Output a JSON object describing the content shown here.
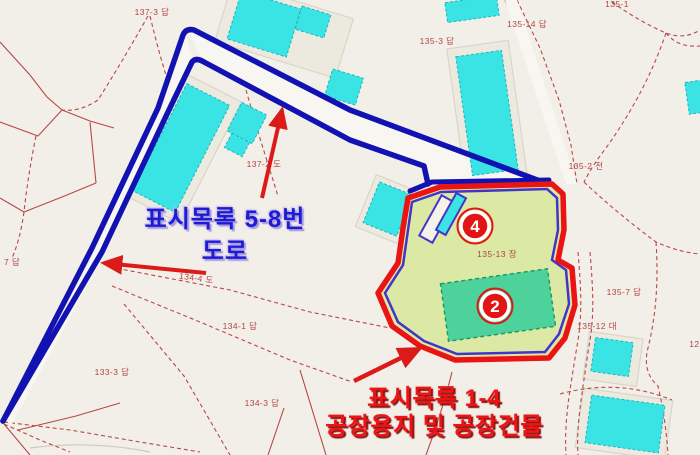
{
  "labels": {
    "road": {
      "line1": "표시목록 5-8번",
      "line2": "도로"
    },
    "factory": {
      "line1": "표시목록 1-4",
      "line2": "공장용지 및 공장건물"
    }
  },
  "markers": [
    {
      "label": "4"
    },
    {
      "label": "2"
    }
  ],
  "parcel_labels": [
    {
      "text": "137-3 답"
    },
    {
      "text": "135-3 답"
    },
    {
      "text": "135-14 답"
    },
    {
      "text": "135-1"
    },
    {
      "text": "135-2 전"
    },
    {
      "text": "135-7 답"
    },
    {
      "text": "135-12 대"
    },
    {
      "text": "123"
    },
    {
      "text": "134-1 답"
    },
    {
      "text": "133-3 답"
    },
    {
      "text": "134-3 답"
    },
    {
      "text": "7 답"
    },
    {
      "text": "137-2 도"
    },
    {
      "text": "135-13 장"
    },
    {
      "text": "134-4 도"
    }
  ],
  "colors": {
    "background": "#f2efe8",
    "parcel_line_red": "#b94747",
    "building_cyan": "#3be4e4",
    "route_blue": "#1212b2",
    "highlight_fill": "#dce9a4",
    "highlight_border_red": "#ea1414",
    "highlight_inner_purple": "#4534c8",
    "factory_building_green": "#4ed29b",
    "marker_red": "#e31414",
    "road_label_blue": "#1c1cd2",
    "factory_label_red": "#ee1414"
  }
}
